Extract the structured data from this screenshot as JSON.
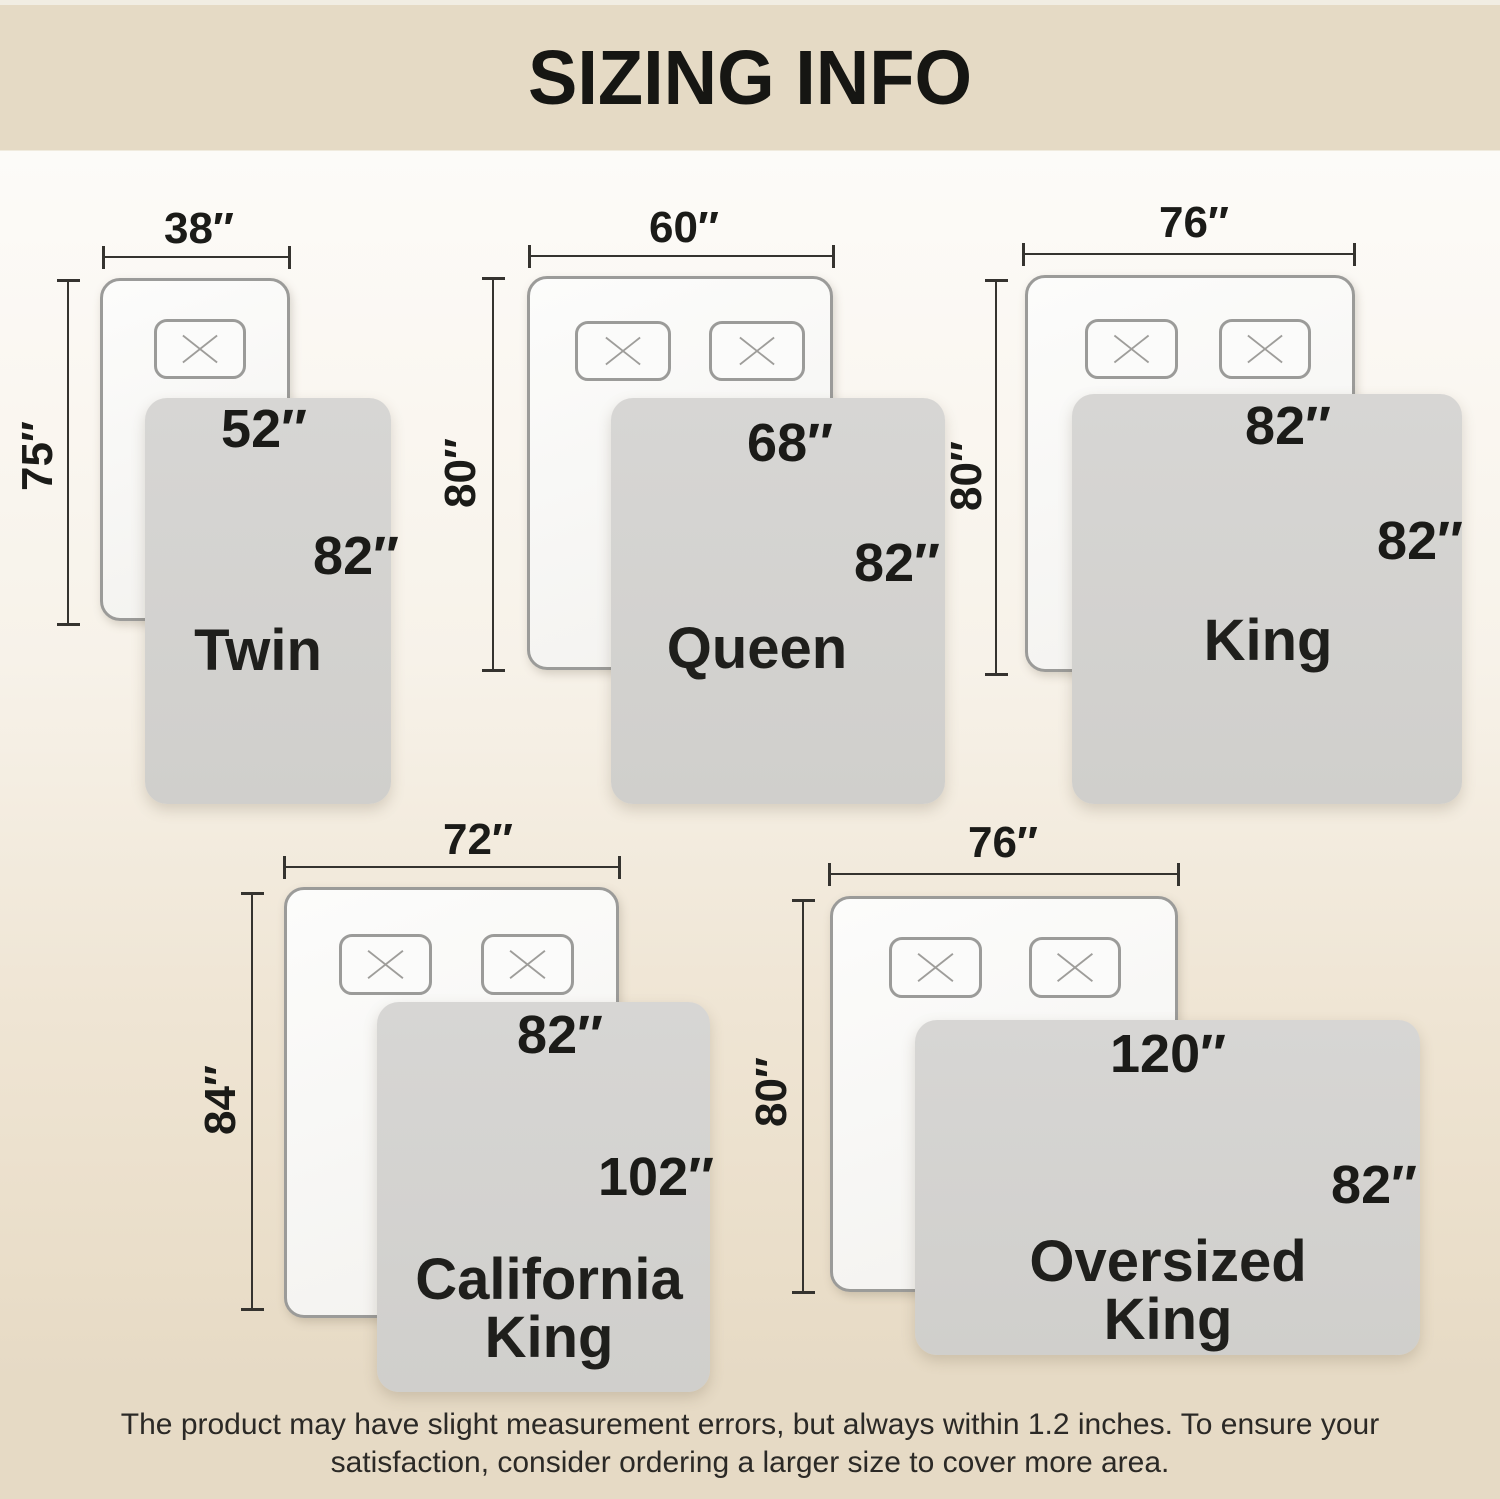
{
  "title": "SIZING INFO",
  "colors": {
    "banner": "#e5dac5",
    "bg_top": "#fcfbf8",
    "bg_bottom": "#e6dac5",
    "bed_fill": "#f7f6f4",
    "bed_border": "#9b9b99",
    "blanket": "#d3d2d0",
    "line": "#35332f",
    "text": "#1b1b18"
  },
  "icons": {
    "pillow": "x-cross"
  },
  "sizes": [
    {
      "name_lines": [
        "Twin"
      ],
      "bed_width": "38″",
      "bed_height": "75″",
      "blanket_width": "52″",
      "blanket_length": "82″",
      "pillow_count": 1
    },
    {
      "name_lines": [
        "Queen"
      ],
      "bed_width": "60″",
      "bed_height": "80″",
      "blanket_width": "68″",
      "blanket_length": "82″",
      "pillow_count": 2
    },
    {
      "name_lines": [
        "King"
      ],
      "bed_width": "76″",
      "bed_height": "80″",
      "blanket_width": "82″",
      "blanket_length": "82″",
      "pillow_count": 2
    },
    {
      "name_lines": [
        "California",
        "King"
      ],
      "bed_width": "72″",
      "bed_height": "84″",
      "blanket_width": "82″",
      "blanket_length": "102″",
      "pillow_count": 2
    },
    {
      "name_lines": [
        "Oversized",
        "King"
      ],
      "bed_width": "76″",
      "bed_height": "80″",
      "blanket_width": "120″",
      "blanket_length": "82″",
      "pillow_count": 2
    }
  ],
  "footer": {
    "line1": "The product may have slight measurement errors, but always within 1.2 inches. To ensure your",
    "line2": "satisfaction, consider ordering a larger size to cover more area."
  }
}
